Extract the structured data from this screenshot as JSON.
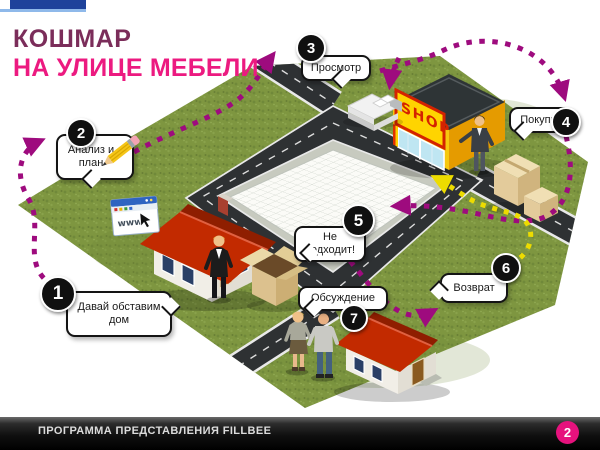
{
  "slide": {
    "title_line1": "КОШМАР",
    "title_line2": "НА УЛИЦЕ МЕБЕЛИ"
  },
  "steps": [
    {
      "number": "1",
      "label": "Давай обставим дом"
    },
    {
      "number": "2",
      "label": "Анализ и план"
    },
    {
      "number": "3",
      "label": "Просмотр"
    },
    {
      "number": "4",
      "label": "Покупка"
    },
    {
      "number": "5",
      "label": "Не подходит!"
    },
    {
      "number": "6",
      "label": "Возврат"
    },
    {
      "number": "7",
      "label": "Обсуждение"
    }
  ],
  "illustration": {
    "shop_sign": "SHOP",
    "browser_label": "www"
  },
  "footer": {
    "text": "ПРОГРАММА ПРЕДСТАВЛЕНИЯ FILLBEE",
    "page_number": "2"
  },
  "colors": {
    "title_primary": "#7B2D5A",
    "title_accent": "#EC1A80",
    "route_magenta": "#9E0B7E",
    "route_yellow": "#EDDC00",
    "badge_pink": "#E6127D",
    "accent_blue": "#1E429B"
  }
}
